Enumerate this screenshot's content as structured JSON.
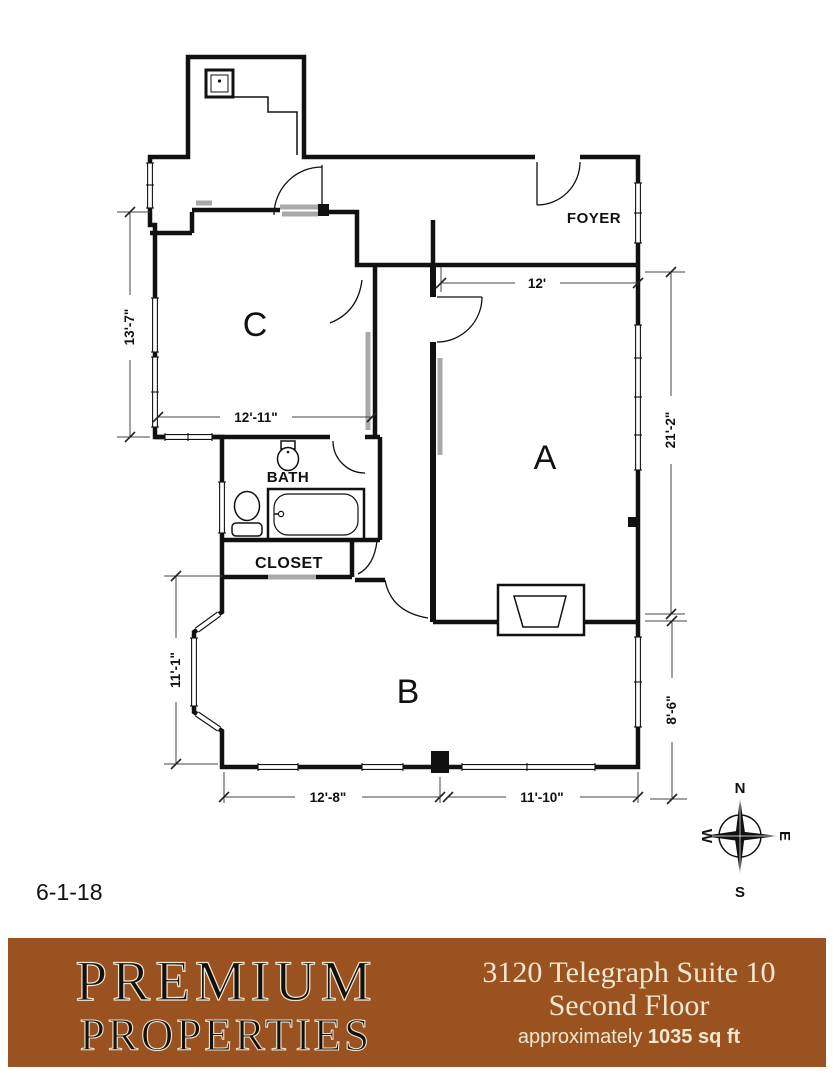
{
  "plan": {
    "date": "6-1-18",
    "rooms": {
      "a": "A",
      "b": "B",
      "c": "C",
      "bath": "BATH",
      "closet": "CLOSET",
      "foyer": "FOYER"
    },
    "dims": {
      "c_height": "13'-7\"",
      "c_width": "12'-11\"",
      "a_width": "12'",
      "a_height": "21'-2\"",
      "bay_height": "11'-1\"",
      "b_right_height": "8'-6\"",
      "b_width_left": "12'-8\"",
      "b_width_right": "11'-10\""
    },
    "compass": {
      "north": "N",
      "south": "S",
      "east": "E",
      "west": "W"
    }
  },
  "icons": [
    "kitchen-sink-icon",
    "toilet-icon",
    "pedestal-sink-icon",
    "bathtub-icon",
    "fireplace-icon",
    "bay-window-icon",
    "compass-rose-icon"
  ],
  "colors": {
    "wall": "#111111",
    "accent_gray": "#a9a9a9",
    "banner_brown": "#9b5221",
    "banner_cream": "#f2e8d0"
  },
  "footer": {
    "brand_line1": "PREMIUM",
    "brand_line2": "PROPERTIES",
    "address_line1": "3120 Telegraph Suite 10",
    "address_line2": "Second Floor",
    "area_prefix": "approximately ",
    "area_value": "1035 sq ft"
  }
}
